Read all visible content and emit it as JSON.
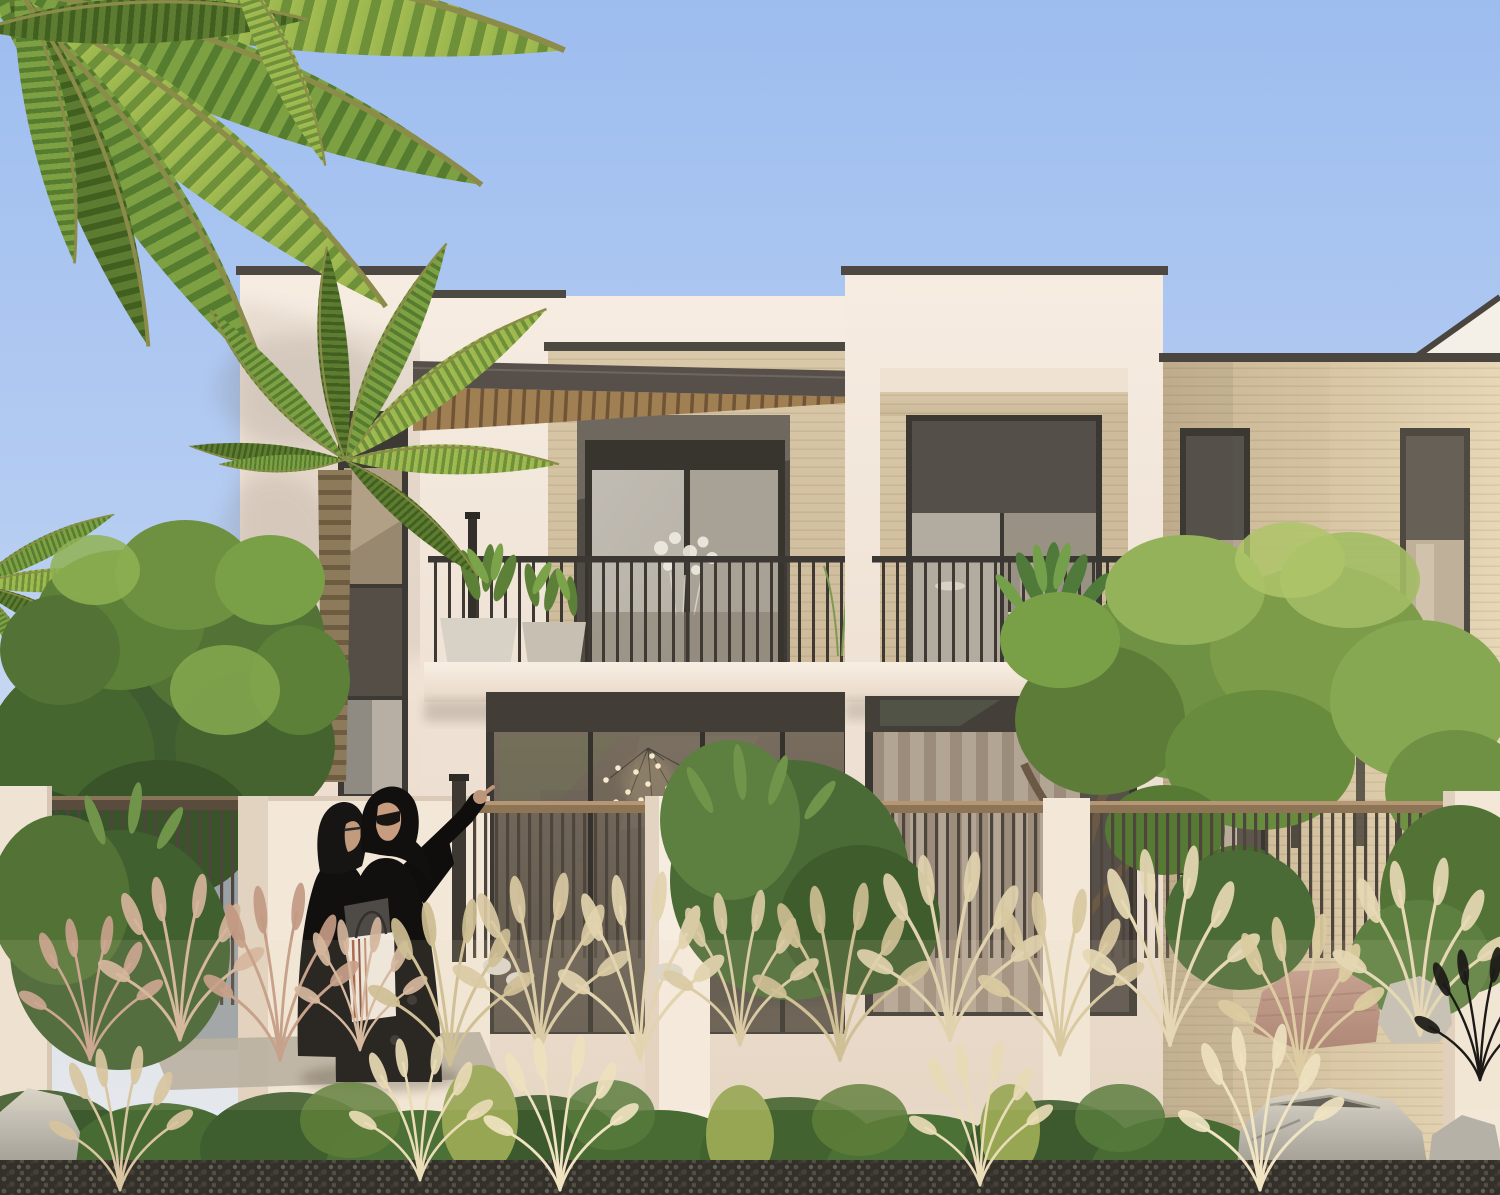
{
  "scene": {
    "type": "photorealistic architectural rendering",
    "subject": "modern two-storey townhouse exterior at golden hour",
    "visible_text": "none",
    "people": {
      "count": 2,
      "details": [
        "woman in black hijab and abaya, seen in profile",
        "woman in black headscarf and sunglasses pointing toward the house, carrying a striped paper bag"
      ]
    },
    "objects": [
      "sky",
      "palm-tree",
      "palm-fronds",
      "left-white-tower",
      "slatted-wood-canopy",
      "stone-clad-facade",
      "first-floor-balcony",
      "metal-railing",
      "balcony-planters",
      "recessed-windows",
      "ground-floor-glazing",
      "interior-chandelier",
      "neighbouring-stone-house",
      "white-gable-roof",
      "boundary-wall",
      "metal-picket-fence",
      "garden-gate",
      "left-tree",
      "right-tree",
      "oleander-shrubs",
      "ornamental-grasses",
      "boxwood-shrubs",
      "boulders",
      "pink-rock",
      "gravel-path",
      "shopping-bag"
    ]
  },
  "palette": {
    "sky_top": "#9dbdef",
    "sky_horizon": "#dbe5f3",
    "wall_white": "#f6ece1",
    "wall_shadow": "#e6d6c6",
    "stone": "#d9c8a9",
    "stone_shadow": "#c8b694",
    "wood_soffit": "#b8925f",
    "wood_rail": "#8c7455",
    "frame_dark": "#3d3934",
    "glass_light": "#b7b1a7",
    "glass_dark": "#5e564c",
    "foliage_dark": "#44632f",
    "foliage_mid": "#6e9144",
    "foliage_light": "#97b255",
    "grass_tan": "#d9caa3",
    "grass_pink": "#c9a18c",
    "abaya_black": "#12100f",
    "rock_grey": "#b3afa4",
    "rock_pink": "#c49c8d",
    "gravel": "#33302a"
  }
}
